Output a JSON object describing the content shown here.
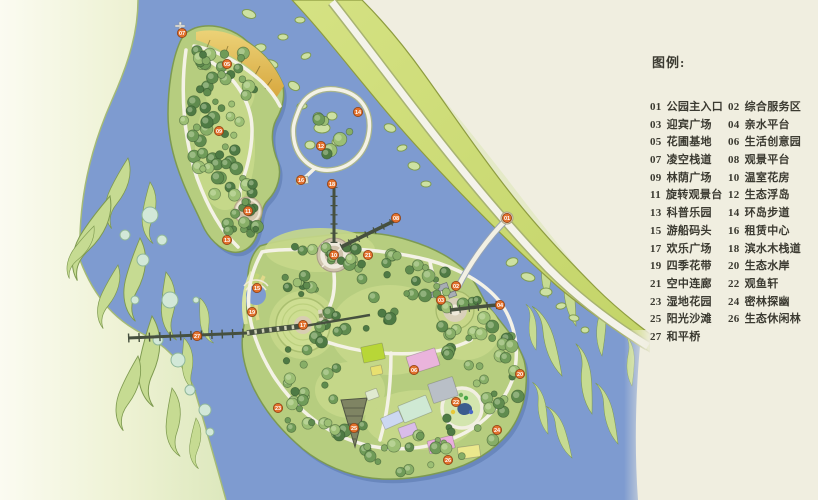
{
  "legend": {
    "title": "图例:",
    "items": [
      {
        "num": "01",
        "label": "公园主入口"
      },
      {
        "num": "02",
        "label": "综合服务区"
      },
      {
        "num": "03",
        "label": "迎宾广场"
      },
      {
        "num": "04",
        "label": "亲水平台"
      },
      {
        "num": "05",
        "label": "花圃基地"
      },
      {
        "num": "06",
        "label": "生活创意园"
      },
      {
        "num": "07",
        "label": "凌空栈道"
      },
      {
        "num": "08",
        "label": "观景平台"
      },
      {
        "num": "09",
        "label": "林荫广场"
      },
      {
        "num": "10",
        "label": "温室花房"
      },
      {
        "num": "11",
        "label": "旋转观景台"
      },
      {
        "num": "12",
        "label": "生态浮岛"
      },
      {
        "num": "13",
        "label": "科普乐园"
      },
      {
        "num": "14",
        "label": "环岛步道"
      },
      {
        "num": "15",
        "label": "游船码头"
      },
      {
        "num": "16",
        "label": "租赁中心"
      },
      {
        "num": "17",
        "label": "欢乐广场"
      },
      {
        "num": "18",
        "label": "滨水木栈道"
      },
      {
        "num": "19",
        "label": "四季花带"
      },
      {
        "num": "20",
        "label": "生态水岸"
      },
      {
        "num": "21",
        "label": "空中连廊"
      },
      {
        "num": "22",
        "label": "观鱼轩"
      },
      {
        "num": "23",
        "label": "湿地花园"
      },
      {
        "num": "24",
        "label": "密林探幽"
      },
      {
        "num": "25",
        "label": "阳光沙滩"
      },
      {
        "num": "26",
        "label": "生态休闲林"
      },
      {
        "num": "27",
        "label": "和平桥"
      }
    ]
  },
  "map": {
    "colors": {
      "cream": "#f0eee0",
      "text": "#3b3a31",
      "water": "#7e9bd0",
      "island": "#b6cd7f",
      "island_edge": "#7d9a52",
      "lawn": "#c7d98b",
      "band_edge": "#8e9c40",
      "path_white": "#f4f2e6",
      "bridge_dark": "#46503f",
      "marker": "#e2702c",
      "beach": "#e3bc55",
      "swirl": "#c6db92",
      "swirl_edge": "#7e9a50",
      "bubble": "#d2e8d8",
      "trees": [
        "#4e7a44",
        "#5f8b4e",
        "#6f9b58",
        "#87ae67",
        "#9cbf74"
      ]
    },
    "markers": [
      {
        "n": "07",
        "x": 182,
        "y": 33
      },
      {
        "n": "05",
        "x": 227,
        "y": 64
      },
      {
        "n": "09",
        "x": 219,
        "y": 131
      },
      {
        "n": "11",
        "x": 248,
        "y": 211
      },
      {
        "n": "13",
        "x": 227,
        "y": 240
      },
      {
        "n": "14",
        "x": 358,
        "y": 112
      },
      {
        "n": "12",
        "x": 321,
        "y": 146
      },
      {
        "n": "16",
        "x": 301,
        "y": 180
      },
      {
        "n": "18",
        "x": 332,
        "y": 184
      },
      {
        "n": "08",
        "x": 396,
        "y": 218
      },
      {
        "n": "10",
        "x": 334,
        "y": 255
      },
      {
        "n": "21",
        "x": 368,
        "y": 255
      },
      {
        "n": "01",
        "x": 507,
        "y": 218
      },
      {
        "n": "02",
        "x": 456,
        "y": 286
      },
      {
        "n": "03",
        "x": 441,
        "y": 300
      },
      {
        "n": "04",
        "x": 500,
        "y": 305
      },
      {
        "n": "15",
        "x": 257,
        "y": 288
      },
      {
        "n": "19",
        "x": 252,
        "y": 312
      },
      {
        "n": "17",
        "x": 303,
        "y": 325
      },
      {
        "n": "27",
        "x": 197,
        "y": 336
      },
      {
        "n": "23",
        "x": 278,
        "y": 408
      },
      {
        "n": "25",
        "x": 354,
        "y": 428
      },
      {
        "n": "06",
        "x": 414,
        "y": 370
      },
      {
        "n": "22",
        "x": 456,
        "y": 402
      },
      {
        "n": "24",
        "x": 497,
        "y": 430
      },
      {
        "n": "26",
        "x": 448,
        "y": 460
      },
      {
        "n": "20",
        "x": 520,
        "y": 374
      }
    ]
  }
}
